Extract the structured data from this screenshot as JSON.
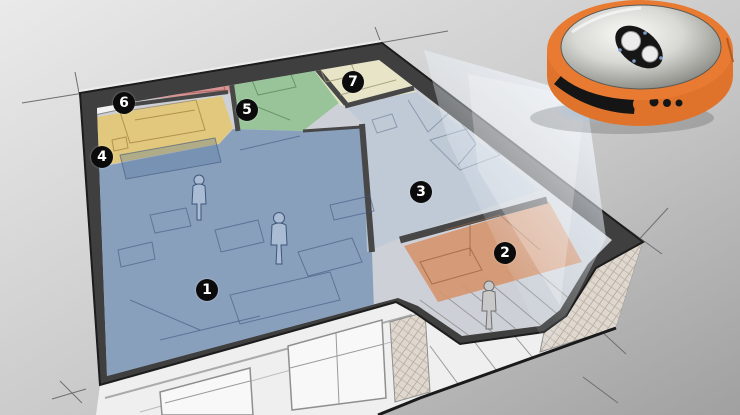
{
  "rooms": [
    {
      "label": "1",
      "color": "#7f99ba"
    },
    {
      "label": "2",
      "color": "#d6936d"
    },
    {
      "label": "3",
      "color": "#bdc9d6"
    },
    {
      "label": "4",
      "color": "#e3c672"
    },
    {
      "label": "5",
      "color": "#93c293"
    },
    {
      "label": "6",
      "color": "#d98d8d"
    },
    {
      "label": "7",
      "color": "#e9e5c6"
    }
  ],
  "palette": {
    "background_top": "#e9e9e9",
    "background_bottom": "#a3a3a3",
    "wall_band": "#3f3f3f",
    "floor_base": "#cdd1d7",
    "facade": "#efefef",
    "brick_hatch": "#ded8d0",
    "dimension_line": "#6f6f6f",
    "marker_bg": "#0b0b0b",
    "marker_text": "#ffffff"
  },
  "robot": {
    "body_color": "#e0732c",
    "rim_color": "#e87a32",
    "dome_color": "#d9d9d5",
    "panel_color": "#161616",
    "button_color": "#ececec",
    "sensor_color": "#151515",
    "indicator_color": "#7e9cc8",
    "beam_color": "#eaf3fc",
    "glow_color": "#9cc2e8",
    "buttons": 2,
    "front_dots": 3
  }
}
